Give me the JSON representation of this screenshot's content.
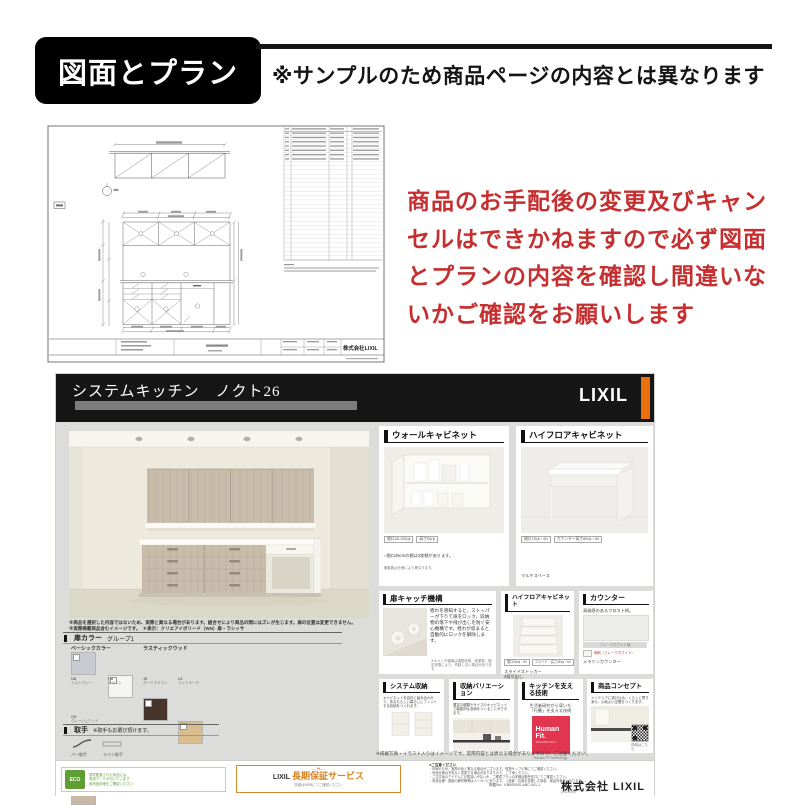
{
  "page": {
    "header": {
      "title": "図面とプラン",
      "note": "※サンプルのため商品ページの内容とは異なります"
    },
    "warning_lines": [
      "商品のお手配後の変更及びキャン",
      "セルはできかねますので必ず図面",
      "とプランの内容を確認し間違いな",
      "いかご確認をお願いします"
    ],
    "colors": {
      "warning_red": "#c62f2f",
      "accent_orange": "#e8700f",
      "humanfit_red": "#e23550",
      "eco_green": "#5f9e33",
      "header_black": "#161616"
    }
  },
  "drawing": {
    "company": "株式会社LIXIL"
  },
  "catalog": {
    "title": "システムキッチン　ノクト26",
    "brand": "LIXIL",
    "render_notes": [
      "※商品を選択した内容ではないため、実際と異なる場合があります。組合せにより商品の間にはズレが生じます。扉の位置は変更できません。",
      "※実際掲載商品含むイメージです。　＊表示：クリエアイボリード（WN）扉・ラシッサ"
    ],
    "door_color": {
      "heading": "扉カラー",
      "group": "グループ1",
      "groups": [
        {
          "name": "ベーシックカラー",
          "swatches": [
            {
              "code": "N8",
              "label": "ミストグレー",
              "color": "#c8ccd2"
            },
            {
              "code": "H8",
              "label": "ホワイト",
              "color": "#f5f5f3"
            }
          ]
        },
        {
          "name": "ラスティックウッド",
          "swatches": [
            {
              "code": "J8",
              "label": "ダークブラウン",
              "color": "#47342a"
            },
            {
              "code": "L8",
              "label": "ライトオーク",
              "color": "#d9bd8e"
            }
          ]
        }
      ],
      "extra": {
        "code": "G8",
        "label": "グレージュウッド",
        "color": "#c9b8a3"
      }
    },
    "handle": {
      "heading": "取手",
      "note": "※取手もお選び頂けます。",
      "options": [
        "バー取手",
        "ライン取手"
      ]
    },
    "worktop": {
      "heading": "ワークトップ",
      "option": "選択"
    },
    "sink": {
      "heading": "シンク",
      "option": "選択"
    },
    "panels": {
      "wall": {
        "title": "ウォールキャビネット",
        "tags": [
          "間口45-105㎝",
          "高さ50㎝"
        ],
        "note1": "○間口45cmの棚は2枚棚があります。",
        "note2": "棚板数は仕様により異なります。"
      },
      "highfloor": {
        "title": "ハイフロアキャビネット",
        "tags": [
          "間口75㎝・80",
          "カウンター高さ85㎝・80"
        ],
        "caption": "マルチスペース"
      },
      "catch": {
        "title": "扉キャッチ機構",
        "body": "揺れを感知すると、ストッパーが下りて扉をロック。収納物の落下や飛び出しを防ぐ安心機構です。揺れが収まると自動的にロックを解除します。",
        "note": "※キャッチ機構は振動状態、荷重物、固定状態により、作動しない場合があります。"
      },
      "highfloor_small": {
        "title": "ハイフロアキャビネット",
        "tags": [
          "間口45㎝・60",
          "スライド・高さ45㎝・60"
        ],
        "caption1": "スライドストッカー",
        "caption2": "4段引出し"
      },
      "counter": {
        "title": "カウンター",
        "body": "高級感のあるフロスト柄。",
        "strip_label": "フレークホワイト柄",
        "chip_note": "柄例（フレークホワイト）",
        "caption": "メラミンカウンター"
      },
      "storage": {
        "title": "システム収納",
        "body": "キャビネットを自在に組み合わせて、あなたらしい暮らしにフィットする収納をつくれます。"
      },
      "variation": {
        "title": "収納バリエーション",
        "body": "豊富な種類やサイズのキャビネットで機能的な収納をつくることができます。"
      },
      "technology": {
        "title": "キッチンを支える技術",
        "body1": "生活者研究から導いた",
        "body2": "「行動」を支える技術",
        "logo": "Human Fit.",
        "logo_sub": "TECHNOLOGY",
        "caption": "Human Fit Technology"
      },
      "concept": {
        "title": "商品コンセプト",
        "body": "インテリアに溶け込み、くらしに寄り添う。心地よい空間をつくります。",
        "qr_caption": "詳細はこちら"
      }
    },
    "footer_note": "※掲載写真・イラスト入りはイメージです。実際内容とは異なる場合がありますので、ご注意ください。",
    "footer": {
      "eco_badge": "ECO",
      "eco_lines": [
        "環境配慮された商品には",
        "専用マークが付いています",
        "各商品詳細をご確認ください"
      ],
      "warranty_deco": "―❖―",
      "warranty_brand": "LIXIL",
      "warranty_label": "長期保証サービス",
      "warranty_sub": "詳細はWEBにてご確認ください",
      "notes_title": "●ご注意ください",
      "notes": [
        "・印刷のため、実際の色と異なる場合がございます。現物サンプル等にてご確認ください。",
        "・商品仕様は予告なく変更する場合がありますので、ご了承ください。",
        "・ご注文後のアイテムにお間違いがないか、ご確認プランの詳細は販売窓口にてご確認ください。",
        "・商品仕様・図面の著作権等はメーカーにあります。（設置・位置を変更した場合、保証対象外となります。）"
      ],
      "doc_no": "掲載No：KB000000-ABC-001-1",
      "doc_sub": "(2023MM)",
      "company": "株式会社 LIXIL"
    }
  }
}
